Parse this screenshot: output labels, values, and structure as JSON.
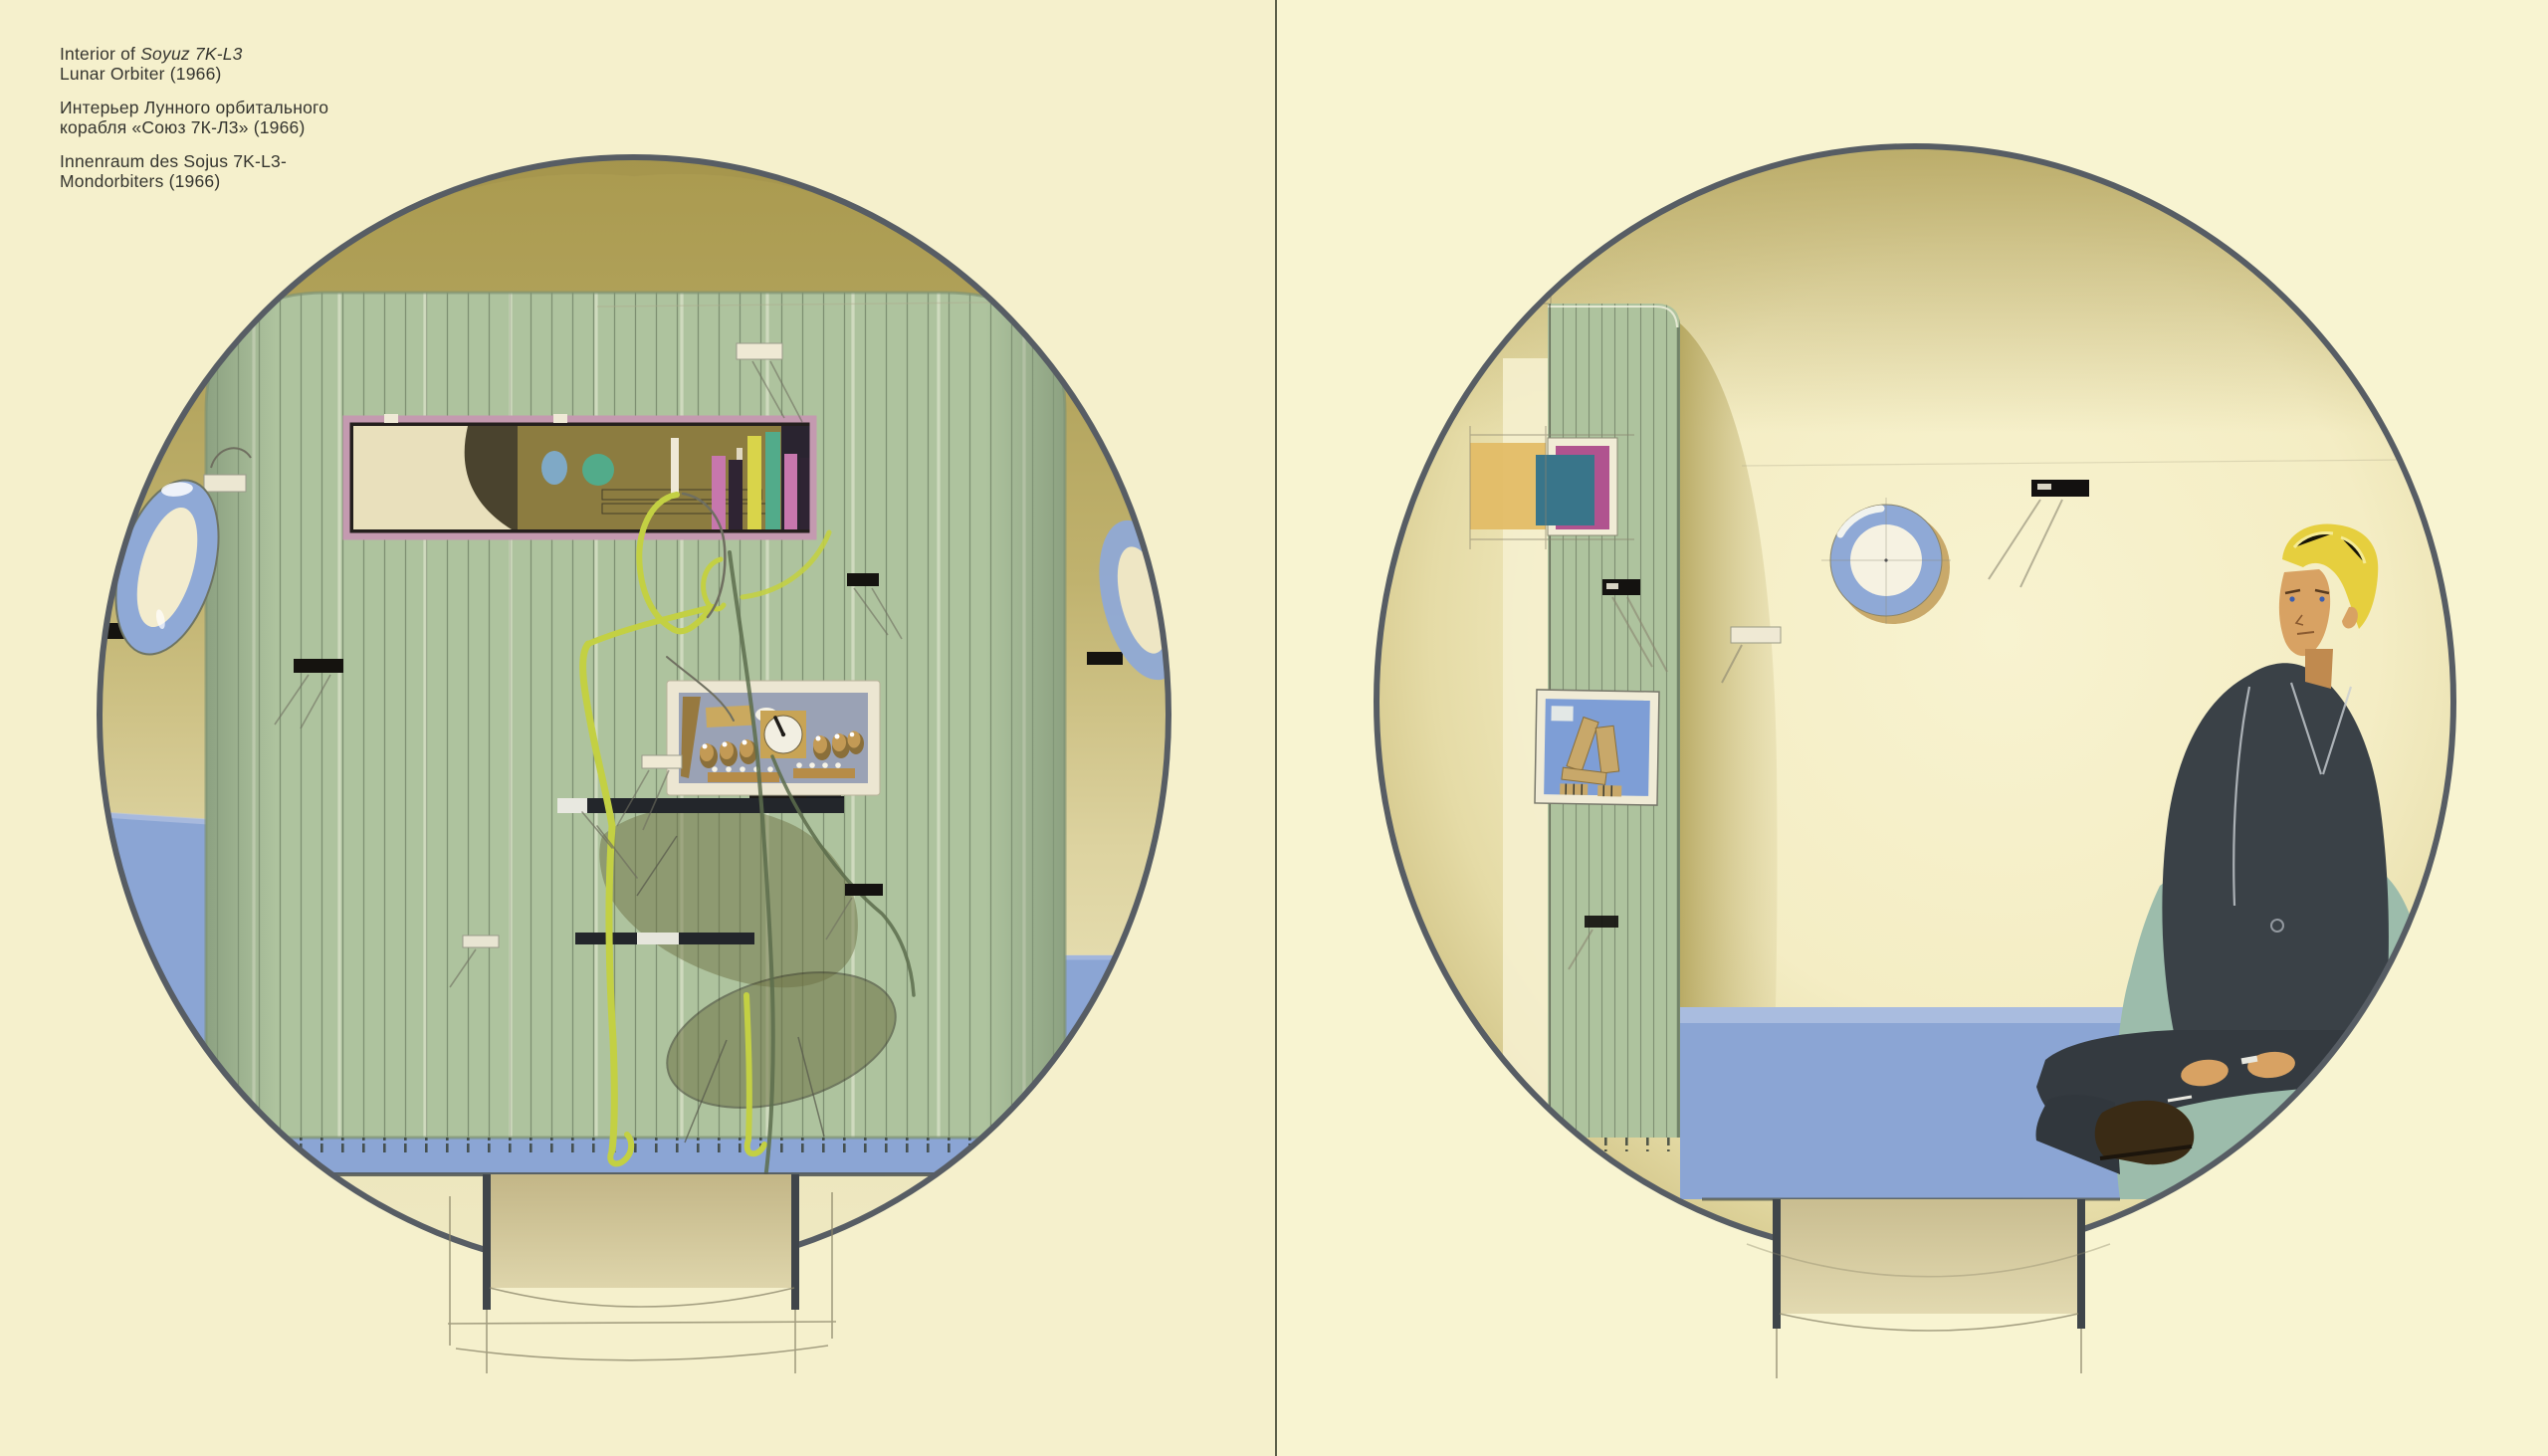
{
  "captions": {
    "english": {
      "prefix": "Interior of ",
      "title_italic": "Soyuz 7K-L3",
      "line2": "Lunar Orbiter (1966)"
    },
    "russian": {
      "line1": "Интерьер Лунного орбитального",
      "line2": "корабля «Союз 7К-Л3» (1966)"
    },
    "german": {
      "line1": "Innenraum des Sojus 7K-L3-",
      "line2": "Mondorbiters (1966)"
    }
  },
  "page": {
    "background_left": "#f5f0cc",
    "background_right": "#f8f4d1",
    "gutter_line": "#5d6049"
  },
  "palette": {
    "circle_outline": "#575d64",
    "hull_olive": "#b2a25c",
    "panel_green": "#aec39e",
    "slat_line": "#6d7e62",
    "floor_blue": "#8ba5d4",
    "porthole_blue": "#8fa9d6",
    "porthole_center": "#f3ecce",
    "cabinet_frame_mauve": "#c49ab0",
    "cabinet_interior_olive": "#8c7c40",
    "console_frame_cream": "#ece6d2",
    "console_face_bluegrey": "#9aa2b5",
    "knob_gold": "#b68c48",
    "figure_outline_chartreuse": "#c3d043",
    "pencil_grey": "#6f6f60",
    "dial_sky": "#7fa9c6",
    "dial_green": "#52ab8a",
    "accent_pink": "#c777ad",
    "accent_yellow": "#d9d44a",
    "accent_dark_plum": "#2f2433",
    "accent_magenta": "#b0538f",
    "accent_teal": "#39758a",
    "accent_amber": "#e3bc66",
    "instrument_blue": "#7e9ed6",
    "instrument_tan": "#c8a86a",
    "hatch_tan": "#c7bb8e",
    "chair_teal": "#9cbcab",
    "suit_charcoal": "#3a4147",
    "trousers_dark": "#31373d",
    "skin": "#d8a263",
    "hair_blond": "#e6cf3e",
    "boot_brown": "#3a2b15"
  }
}
